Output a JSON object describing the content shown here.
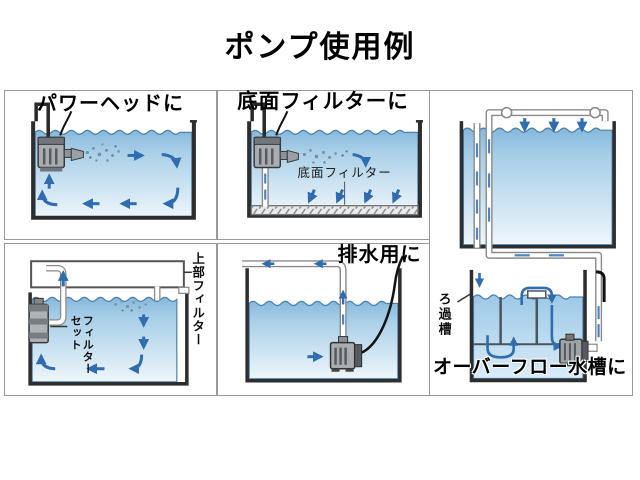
{
  "page": {
    "title": "ポンプ使用例"
  },
  "panels": {
    "power_head": {
      "title": "パワーヘッドに"
    },
    "bottom_filter": {
      "title": "底面フィルターに",
      "plate_label": "底面フィルター"
    },
    "top_filter": {
      "side_label": "上部フィルター",
      "pump_label_right": "フィルター",
      "pump_label_left": "セット"
    },
    "drainage": {
      "title": "排水用に"
    },
    "overflow": {
      "title": "オーバーフロー水槽に",
      "sump_label": "ろ過槽"
    }
  },
  "colors": {
    "arrow_blue": "#2f6cb0",
    "water_top": "#86b9dc",
    "water_bottom": "#eef6fb",
    "tank_wall": "#2e2e2e",
    "panel_border": "#9a9a9a",
    "pipe_outline": "#8a8a8a"
  }
}
